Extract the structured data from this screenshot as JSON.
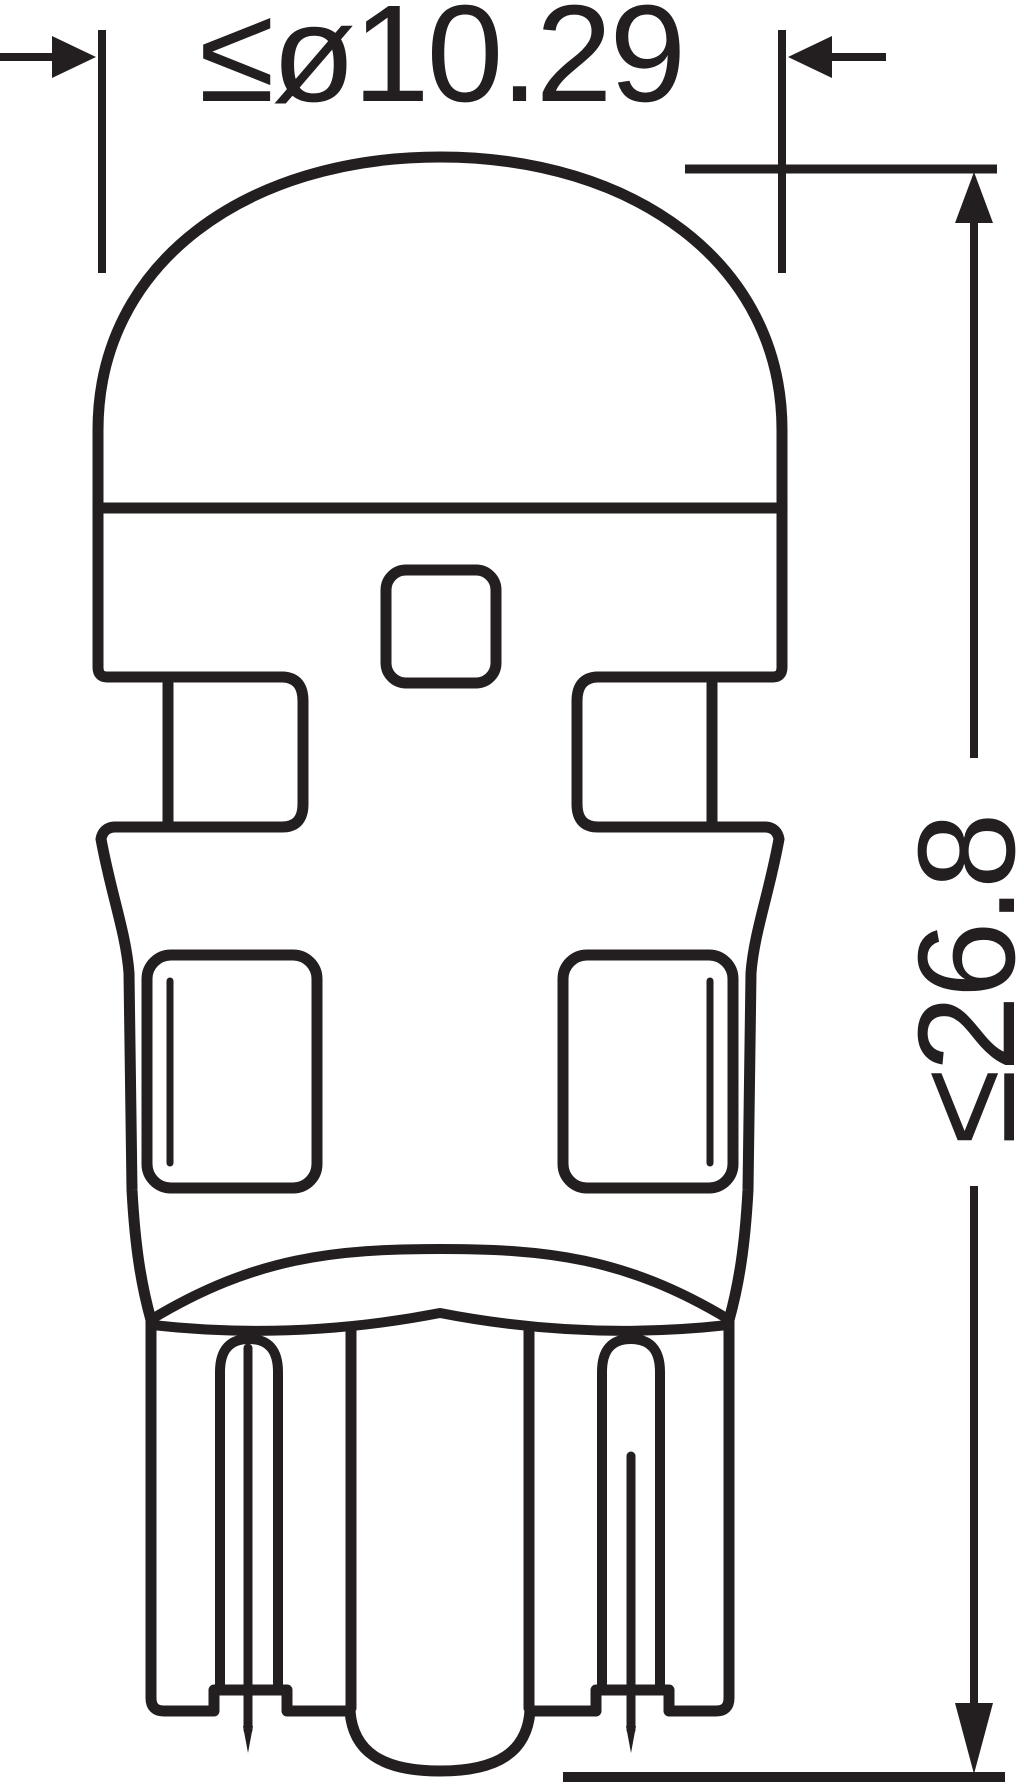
{
  "palette": {
    "ink": "#231F20",
    "background": "#FFFFFF"
  },
  "drawing": {
    "kind": "technical-dimension-drawing",
    "subject": "wedge-base LED retrofit bulb, side profile"
  },
  "dimension_width": {
    "label": "≤ø10.29"
  },
  "dimension_height": {
    "label": "≤26.8"
  }
}
